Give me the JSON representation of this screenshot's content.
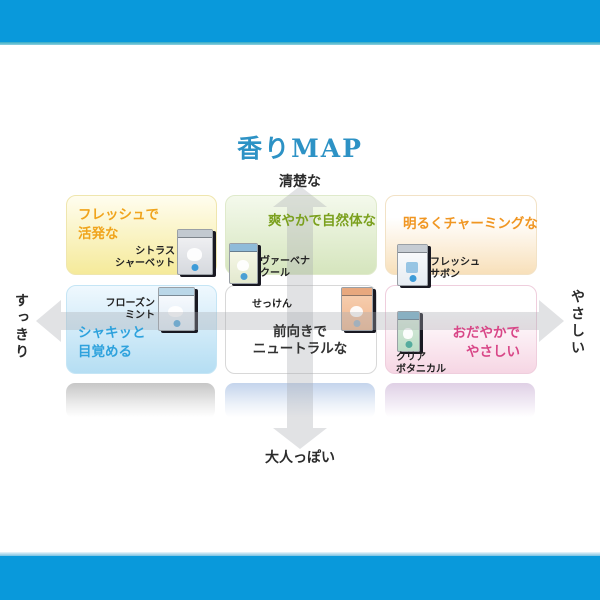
{
  "title": "香りMAP",
  "axes": {
    "top": "清楚な",
    "bottom": "大人っぽい",
    "left": "すっきり",
    "right": "やさしい"
  },
  "colors": {
    "frame_blue": "#0999DB",
    "title_blue": "#2D92C5",
    "fresh_active_accent": "#F0A41C",
    "natural_accent": "#7BA01E",
    "charming_accent": "#F09622",
    "awake_accent": "#2EA2DD",
    "neutral_accent": "#333333",
    "gentle_accent": "#D84687"
  },
  "quadrants": {
    "fresh_active": {
      "line1": "フレッシュで",
      "line2": "活発な",
      "product1": "シトラス",
      "product2": "シャーベット"
    },
    "natural": {
      "line1": "爽やかで自然体な",
      "product1": "ヴァーベナ",
      "product2": "クール"
    },
    "charming": {
      "line1": "明るくチャーミングな",
      "product1": "フレッシュ",
      "product2": "サボン"
    },
    "awake": {
      "line1": "シャキッと",
      "line2": "目覚める",
      "product1": "フローズン",
      "product2": "ミント"
    },
    "neutral": {
      "line1": "前向きで",
      "line2": "ニュートラルな",
      "product1": "せっけん"
    },
    "gentle": {
      "line1": "おだやかで",
      "line2": "やさしい",
      "product1": "クリア",
      "product2": "ボタニカル"
    }
  }
}
